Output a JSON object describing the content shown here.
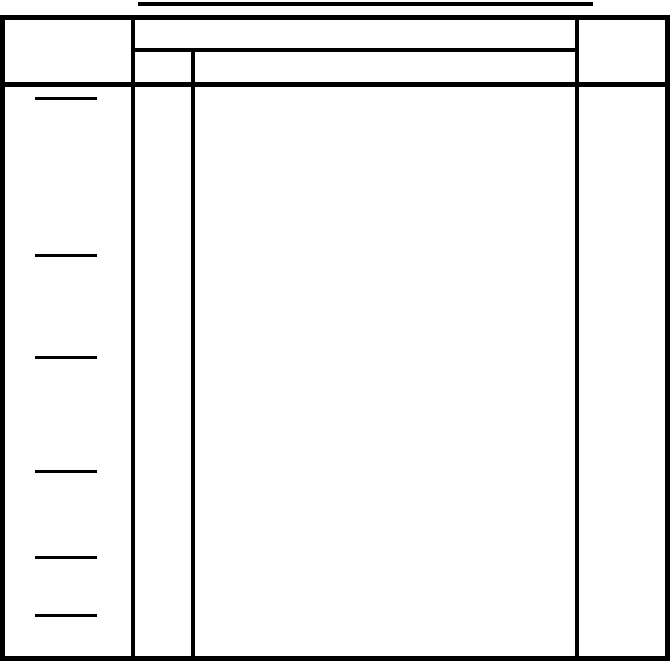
{
  "page": {
    "background_color": "#ffffff",
    "line_color": "#000000"
  },
  "title": {
    "text": ""
  },
  "table": {
    "header": {
      "left": "",
      "middle_merged": "",
      "middle_sub_left": "",
      "middle_sub_right": "",
      "right": ""
    },
    "body": {
      "left": "",
      "sub_left": "",
      "main": "",
      "right": ""
    },
    "left_column_blank_lines": [
      {
        "top_px": 97
      },
      {
        "top_px": 254
      },
      {
        "top_px": 356
      },
      {
        "top_px": 470
      },
      {
        "top_px": 556
      },
      {
        "top_px": 614
      }
    ]
  }
}
